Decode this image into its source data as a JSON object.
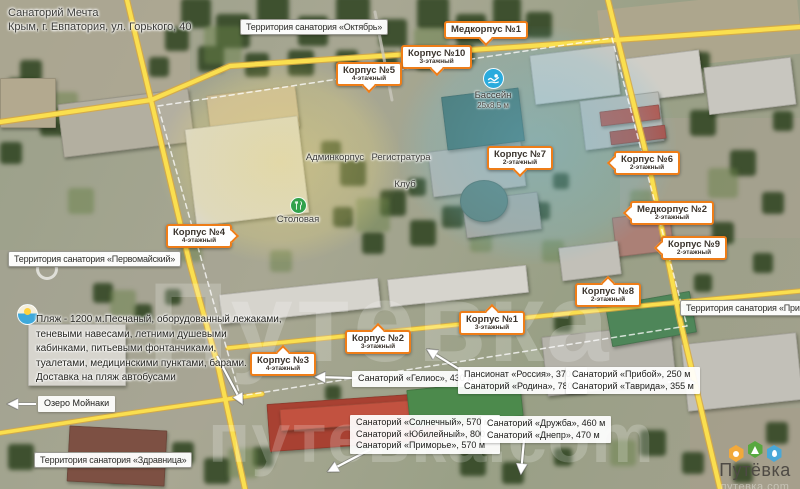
{
  "page": {
    "title": "Санаторий Мечта",
    "subtitle": "Крым, г. Евпатория, ул. Горького, 40"
  },
  "watermarks": {
    "middle": "Путевка",
    "bottom": "путевка.com"
  },
  "logo": {
    "brand": "Путёвка",
    "domain": "путевка.com"
  },
  "colors": {
    "accent_orange": "#ee7d18",
    "road_yellow": "#f7da4a",
    "pool_blue": "#2aabdd",
    "dining_green": "#31a24c"
  },
  "territory_labels": [
    {
      "text": "Территория санатория «Октябрь»",
      "x": 240,
      "y": 19
    },
    {
      "text": "Территория санатория «Первомайский»",
      "x": 8,
      "y": 251
    },
    {
      "text": "Территория санатория «Прибой»",
      "x": 680,
      "y": 300
    },
    {
      "text": "Территория санатория «Здравница»",
      "x": 34,
      "y": 452
    }
  ],
  "building_labels": [
    {
      "title": "Медкорпус №1",
      "subtitle": "",
      "arrow": "down",
      "x": 444,
      "y": 21
    },
    {
      "title": "Корпус №10",
      "subtitle": "3-этажный",
      "arrow": "down",
      "x": 401,
      "y": 45
    },
    {
      "title": "Корпус №5",
      "subtitle": "4-этажный",
      "arrow": "down",
      "x": 336,
      "y": 62
    },
    {
      "title": "Корпус №7",
      "subtitle": "2-этажный",
      "arrow": "down",
      "x": 487,
      "y": 146
    },
    {
      "title": "Корпус №6",
      "subtitle": "2-этажный",
      "arrow": "left",
      "x": 614,
      "y": 151
    },
    {
      "title": "Медкорпус №2",
      "subtitle": "2-этажный",
      "arrow": "left",
      "x": 630,
      "y": 201
    },
    {
      "title": "Корпус №9",
      "subtitle": "2-этажный",
      "arrow": "left",
      "x": 661,
      "y": 236
    },
    {
      "title": "Корпус №8",
      "subtitle": "2-этажный",
      "arrow": "up",
      "x": 575,
      "y": 283
    },
    {
      "title": "Корпус №4",
      "subtitle": "4-этажный",
      "arrow": "right",
      "x": 166,
      "y": 224
    },
    {
      "title": "Корпус №3",
      "subtitle": "4-этажный",
      "arrow": "up",
      "x": 250,
      "y": 352
    },
    {
      "title": "Корпус №2",
      "subtitle": "3-этажный",
      "arrow": "up",
      "x": 345,
      "y": 330
    },
    {
      "title": "Корпус №1",
      "subtitle": "3-этажный",
      "arrow": "up",
      "x": 459,
      "y": 311
    }
  ],
  "distance_labels": [
    {
      "lines": [
        "Санаторий «Гелиос», 430 м"
      ],
      "x": 352,
      "y": 371
    },
    {
      "lines": [
        "Пансионат «Россия», 370 м",
        "Санаторий «Родина», 780 м"
      ],
      "x": 458,
      "y": 367
    },
    {
      "lines": [
        "Санаторий «Прибой», 250 м",
        "Санаторий «Таврида», 355 м"
      ],
      "x": 566,
      "y": 367
    },
    {
      "lines": [
        "Санаторий «Солнечный», 570 м",
        "Санаторий «Юбилейный», 800 м",
        "Санаторий «Приморье», 570 м"
      ],
      "x": 350,
      "y": 415
    },
    {
      "lines": [
        "Санаторий «Дружба», 460 м",
        "Санаторий «Днепр», 470 м"
      ],
      "x": 481,
      "y": 416
    },
    {
      "lines": [
        "Озеро Мойнаки"
      ],
      "x": 38,
      "y": 396
    }
  ],
  "map_texts": [
    {
      "text": "Админкорпус",
      "x": 335,
      "y": 152
    },
    {
      "text": "Регистратура",
      "x": 401,
      "y": 152
    },
    {
      "text": "Клуб",
      "x": 405,
      "y": 179
    },
    {
      "text": "Столовая",
      "x": 298,
      "y": 214
    }
  ],
  "poi": {
    "pool": {
      "label": "Бассейн",
      "size": "25x8.5 м"
    }
  },
  "beach_note": {
    "lines": [
      "Пляж - 1200 м.Песчаный, оборудованный лежаками,",
      "теневыми навесами, летними душевыми",
      "кабинками, питьевыми фонтанчиками,",
      "туалетами, медицинскими пунктами, барами.",
      "Доставка на пляж автобусами"
    ]
  },
  "arrows": [
    {
      "x1": 352,
      "y1": 378,
      "x2": 316,
      "y2": 377
    },
    {
      "x1": 462,
      "y1": 371,
      "x2": 428,
      "y2": 350
    },
    {
      "x1": 668,
      "y1": 382,
      "x2": 694,
      "y2": 383
    },
    {
      "x1": 371,
      "y1": 449,
      "x2": 329,
      "y2": 471
    },
    {
      "x1": 524,
      "y1": 440,
      "x2": 521,
      "y2": 473
    },
    {
      "x1": 36,
      "y1": 404,
      "x2": 9,
      "y2": 404
    },
    {
      "x1": 217,
      "y1": 356,
      "x2": 242,
      "y2": 403
    }
  ]
}
